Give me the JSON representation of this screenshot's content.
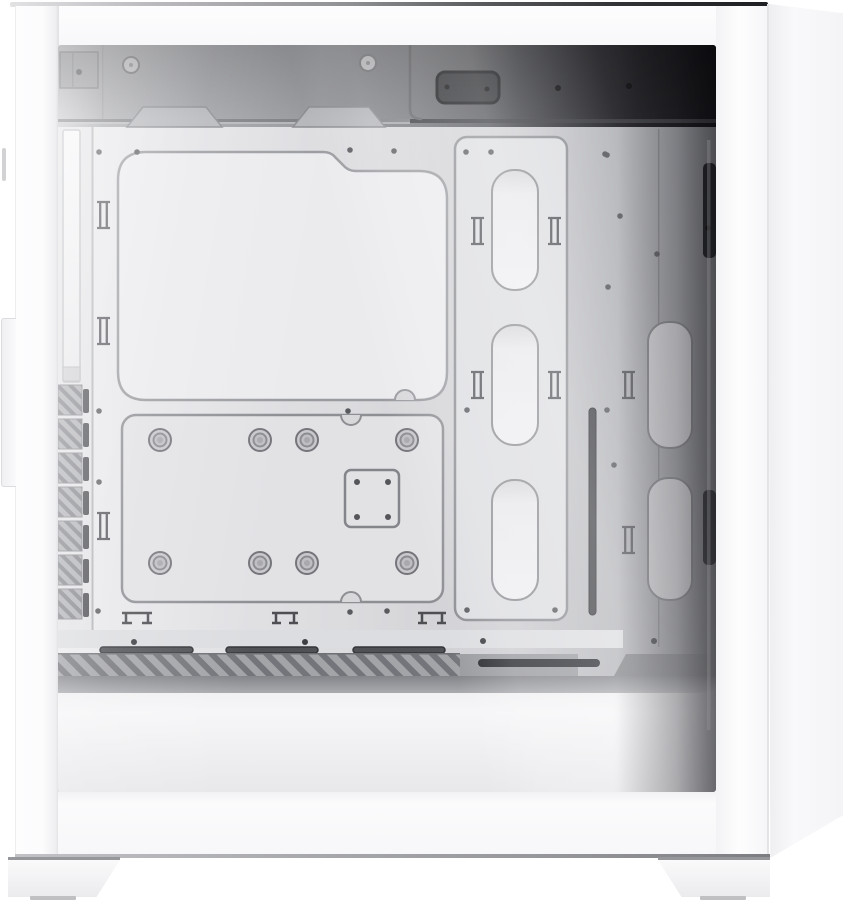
{
  "image": {
    "type": "product-photo",
    "alt": "White mid-tower ATX PC case, left side view with tinted tempered-glass side panel revealing an empty white interior",
    "background_color": "#ffffff"
  },
  "case": {
    "color_name": "white",
    "orientation": "side profile, front panel at left, rear chamfer at right, two angled feet at bottom",
    "parts": {
      "front_panel": "flat white front panel with protruding trim lip",
      "top_panel": "white top panel seen edge-on as thin gradient line",
      "glass_panel": "tinted tempered-glass side window, dark toward top and rear",
      "rear_chamfer": "angled white rear edge of the chassis",
      "psu_shroud": "white power-supply shroud with diagonal louver vents and cable slots",
      "feet": "two white wedge-shaped case feet with gray rubber pads"
    },
    "interior": {
      "top_rail": "roof fan rail with two trapezoid mounting tabs, screw rings and a dark hub cutout",
      "motherboard_tray": "bare white motherboard tray with standoff holes",
      "cpu_cutout": "large stepped rounded-rectangle CPU cooler backplate cutout",
      "cable_channel": "vertical cable-routing channel plate with three oblong pass-through cutouts",
      "rear_cutouts": "two oblong cable cutouts beside the rear column",
      "pump_bracket": "square pump mounting plate with four screw holes",
      "grommet_plate": "lower mounting plate with eight rubber grommets in two rows of four and half-round notches",
      "tie_points": "ladder-style cable-tie loops and I-beam tie slots",
      "front_rail": "front fan rail with bright LED diffuser strip, seven louvered vent blocks and slot column",
      "rear_shadow_bars": "dark vertical rear-fan rail slots near the back wall",
      "thin_slot": "long thin vertical routing slot"
    },
    "palette": {
      "case_white": "#fbfbfc",
      "interior_light": "#e9e9ec",
      "interior_mid": "#c6c6ca",
      "interior_dark": "#141417",
      "line_gray": "#8e8f93",
      "slot_dark": "#2b2c30",
      "slat_gray": "#74757a"
    }
  },
  "counts": {
    "grommets": 8,
    "channel_cutouts": 3,
    "rear_cutouts": 2,
    "front_vent_blocks": 7,
    "shroud_top_slots": 3,
    "trapezoid_tabs": 2,
    "feet": 2
  }
}
